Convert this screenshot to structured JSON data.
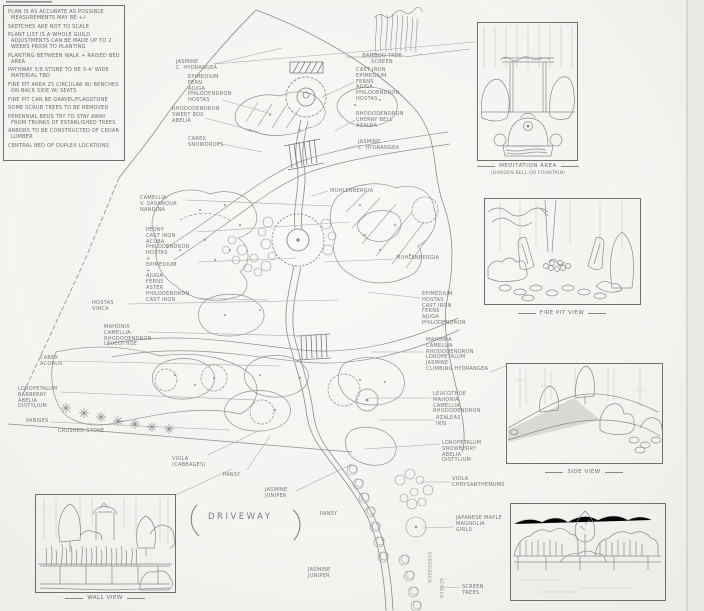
{
  "notes": {
    "lines": [
      "Plan is as accurate as possible measurements may be +/-",
      "Sketches are not to scale",
      "Plant list is a whole guild adjustments can be made up to 2 weeks prior to planting",
      "Planting between walk + raised bed area",
      "Pathway 5/8 stone to be 3-4' wide material TBD",
      "Fire pit area 25 circular w/ benches on back side w/ seats",
      "Fire pit can be gravel/flagstone",
      "Some scrub trees to be removed",
      "Perennial beds try to stay away from trunks of established trees",
      "Arbors to be constructed of cedar lumber",
      "Central bed of duplex locations"
    ]
  },
  "plan": {
    "driveway_label": "DRIVEWAY",
    "vertical_labels": [
      {
        "text": "EVERGREEN"
      },
      {
        "text": "SCREEN"
      }
    ],
    "labels": [
      {
        "text": "Camellia\nV. Sasanqua\nNandina"
      },
      {
        "text": "Peony\nCast Iron\nAcuba\nPhilodendron\nHostas\n+\nEpimedium\n+\nAjuga\nFerns\nAster\nPhilodendron\nCast Iron"
      },
      {
        "text": "Hostas\nVinca"
      },
      {
        "text": "Mahonia\nCamellia\nRhododendron\nLeucothoe"
      },
      {
        "text": "Carex\nAcorus"
      },
      {
        "text": "Loropetalum\nBarberry\nAbelia\nDistylium"
      },
      {
        "text": "Pansies"
      },
      {
        "text": "Crushed Stone"
      },
      {
        "text": "Viola\n(Cabbages)"
      },
      {
        "text": "Pansy"
      },
      {
        "text": "Jasmine\nJuniper"
      },
      {
        "text": "Pansy"
      },
      {
        "text": "Jasmine\nJuniper"
      },
      {
        "text": "Jasmine\nC. Hydrangea"
      },
      {
        "text": "Epimedium\nFern\nAjuga\nPhilodendron\nHostas"
      },
      {
        "text": "Rhododendron\nSweet Box\nAbelia"
      },
      {
        "text": "Carex\nSnowdrops"
      },
      {
        "text": "Bamboo Tree\nScreen"
      },
      {
        "text": "Cast Iron\nEpimedium\nFerns\nAjuga\nPhilodendron\nHostas"
      },
      {
        "text": "Rhododendron\nCherry Bell\nAzalea"
      },
      {
        "text": "Jasmine\nC. Hydrangea"
      },
      {
        "text": "Muhlenbergia"
      },
      {
        "text": "Muhlenbergia"
      },
      {
        "text": "Epimedium\nHostas\nCast Iron\nFerns\nAjuga\nPhilodendron"
      },
      {
        "text": "Mahonia\nCamellia\nRhododendron\nLoropetalum\nJasmine\nClimbing Hydrangea"
      },
      {
        "text": "Leucothoe\nMahonia\nCamellia\nRhododendron"
      },
      {
        "text": "Azaleas\nIris"
      },
      {
        "text": "Loropetalum\nSnowberry\nAbelia\nDistylium"
      },
      {
        "text": "Viola\nChrysanthemums"
      },
      {
        "text": "Japanese Maple\nMagnolia\nGirls"
      },
      {
        "text": "Screen\nTrees"
      }
    ]
  },
  "insets": {
    "meditation": {
      "caption": "Meditation Area",
      "subcaption": "(Garden Bell or Fountain)"
    },
    "fire_pit": {
      "caption": "Fire Pit View"
    },
    "side": {
      "caption": "Side View"
    },
    "wall": {
      "caption": "Wall View"
    }
  },
  "colors": {
    "ink": "#8d8d8d",
    "dark_ink": "#6f6f6f",
    "paper": "#f6f5f2"
  }
}
